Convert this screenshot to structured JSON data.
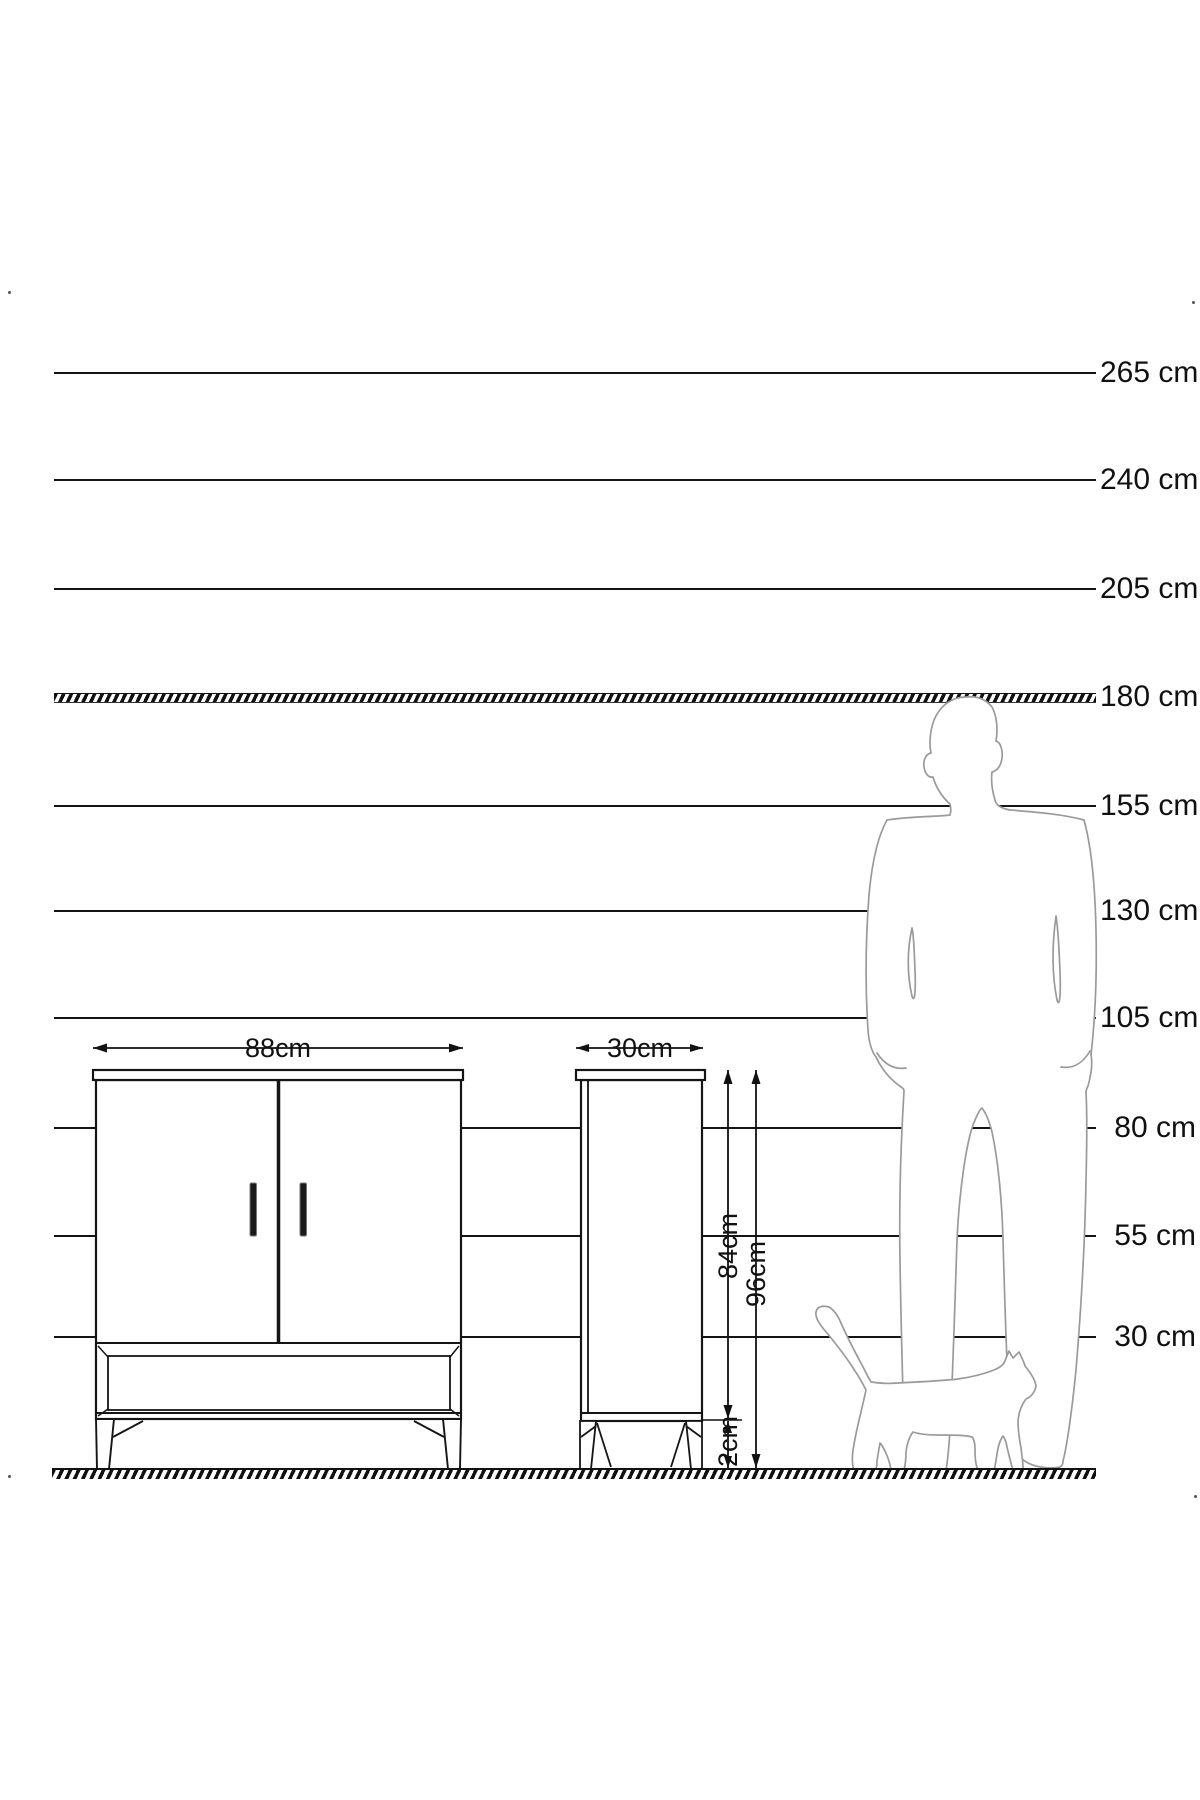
{
  "diagram": {
    "description": "Furniture size diagram with height reference scale, cabinet front and side views, man and cat silhouettes",
    "unit": "cm"
  },
  "scale": {
    "labels": [
      "265 cm",
      "240 cm",
      "205 cm",
      "180 cm",
      "155 cm",
      "130 cm",
      "105 cm",
      "80 cm",
      "55 cm",
      "30 cm"
    ],
    "values_cm": [
      265,
      240,
      205,
      180,
      155,
      130,
      105,
      80,
      55,
      30
    ],
    "highlighted_value_cm": 180
  },
  "dims": {
    "width": "88cm",
    "depth": "30cm",
    "body_height": "84cm",
    "total_height": "96cm",
    "leg_height": "12cm"
  },
  "figures": {
    "man": "standing man silhouette (180 cm tall)",
    "cat": "walking cat silhouette",
    "cabinet_front": "two-door cabinet with lower drawer, front view",
    "cabinet_side": "cabinet side view"
  },
  "colors": {
    "ink": "#151515",
    "silhouette": "#9a9a9a",
    "background": "#ffffff"
  }
}
